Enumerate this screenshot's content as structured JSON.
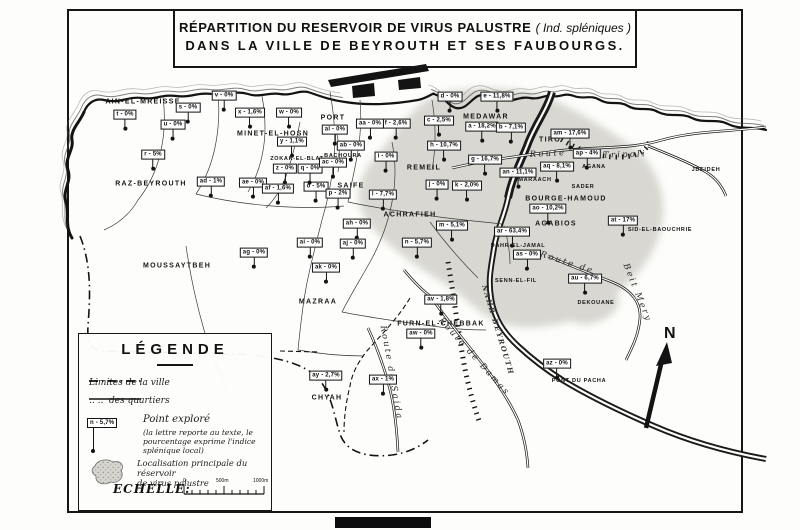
{
  "title": {
    "main": "RÉPARTITION DU RESERVOIR DE VIRUS PALUSTRE",
    "paren": "( Ind. spléniques )",
    "line2": "DANS LA VILLE DE BEYROUTH ET SES FAUBOURGS."
  },
  "compass": {
    "north_label": "N"
  },
  "legend": {
    "title": "LÉGENDE",
    "limits_city": "Limites de la ville",
    "limits_quarters_ditto": "..   ..",
    "limits_quarters": "des quartiers",
    "point_explored": "Point exploré",
    "point_note": "(la lettre reporte au texte, le pourcentage exprime l'indice splénique local)",
    "sample_point_label": "n - 5,7%",
    "reservoir_line1": "Localisation principale du réservoir",
    "reservoir_line2": "de virus palustre",
    "scale_title": "ECHELLE:",
    "scale_ticks": [
      "0",
      "500m",
      "1000m"
    ]
  },
  "colors": {
    "ink": "#131313",
    "paper": "#fdfdfb",
    "reservoir_stipple": "#a09f97"
  },
  "map": {
    "districts": [
      {
        "name": "AIN-EL-MREISSE",
        "x": 143,
        "y": 102,
        "small": false
      },
      {
        "name": "MINET-EL-HOSN",
        "x": 273,
        "y": 134,
        "small": false
      },
      {
        "name": "PORT",
        "x": 333,
        "y": 118,
        "small": false
      },
      {
        "name": "MEDAWAR",
        "x": 486,
        "y": 117,
        "small": false
      },
      {
        "name": "TIRO",
        "x": 550,
        "y": 140,
        "small": false
      },
      {
        "name": "RAZ-BEYROUTH",
        "x": 151,
        "y": 184,
        "small": false
      },
      {
        "name": "ZOKAK-EL-BLAT",
        "x": 297,
        "y": 159,
        "small": true
      },
      {
        "name": "BACHOURA",
        "x": 343,
        "y": 156,
        "small": true
      },
      {
        "name": "SAIFE",
        "x": 351,
        "y": 186,
        "small": false
      },
      {
        "name": "REMEIL",
        "x": 424,
        "y": 168,
        "small": false
      },
      {
        "name": "ACHRAFIEH",
        "x": 410,
        "y": 215,
        "small": false
      },
      {
        "name": "MARAACH",
        "x": 535,
        "y": 180,
        "small": true
      },
      {
        "name": "SADER",
        "x": 583,
        "y": 187,
        "small": true
      },
      {
        "name": "AGANA",
        "x": 594,
        "y": 167,
        "small": true
      },
      {
        "name": "BOURGE-HAMOUD",
        "x": 566,
        "y": 199,
        "small": false
      },
      {
        "name": "AGABIOS",
        "x": 556,
        "y": 224,
        "small": false
      },
      {
        "name": "SID-EL-BAOUCHRIE",
        "x": 660,
        "y": 230,
        "small": true
      },
      {
        "name": "JDEIDEH",
        "x": 706,
        "y": 170,
        "small": true
      },
      {
        "name": "DAHR-EL-JAMAL",
        "x": 518,
        "y": 246,
        "small": true
      },
      {
        "name": "SENN-EL-FIL",
        "x": 516,
        "y": 281,
        "small": true
      },
      {
        "name": "DEKOUANE",
        "x": 596,
        "y": 303,
        "small": true
      },
      {
        "name": "MOUSSAYTBEH",
        "x": 177,
        "y": 266,
        "small": false
      },
      {
        "name": "MAZRAA",
        "x": 318,
        "y": 302,
        "small": false
      },
      {
        "name": "CHYAH",
        "x": 327,
        "y": 398,
        "small": false
      },
      {
        "name": "FURN-EL-CHEBBAK",
        "x": 441,
        "y": 324,
        "small": false
      },
      {
        "name": "PONT DU PACHA",
        "x": 579,
        "y": 381,
        "small": true
      }
    ],
    "points": [
      {
        "id": "a",
        "label": "a - 18,2%",
        "x": 482,
        "y": 130
      },
      {
        "id": "b",
        "label": "b - 7,1%",
        "x": 511,
        "y": 131
      },
      {
        "id": "c",
        "label": "c - 2,5%",
        "x": 439,
        "y": 124
      },
      {
        "id": "d",
        "label": "d - 0%",
        "x": 450,
        "y": 100
      },
      {
        "id": "e",
        "label": "e - 11,8%",
        "x": 497,
        "y": 100
      },
      {
        "id": "f",
        "label": "f - 2,6%",
        "x": 396,
        "y": 127
      },
      {
        "id": "g",
        "label": "g - 16,7%",
        "x": 485,
        "y": 163
      },
      {
        "id": "h",
        "label": "h - 10,7%",
        "x": 444,
        "y": 149
      },
      {
        "id": "i",
        "label": "i - 0%",
        "x": 386,
        "y": 160
      },
      {
        "id": "j",
        "label": "j - 0%",
        "x": 437,
        "y": 188
      },
      {
        "id": "k",
        "label": "k - 2,0%",
        "x": 467,
        "y": 189
      },
      {
        "id": "l",
        "label": "l - 7,7%",
        "x": 383,
        "y": 198
      },
      {
        "id": "m",
        "label": "m - 5,1%",
        "x": 452,
        "y": 229
      },
      {
        "id": "n",
        "label": "n - 5,7%",
        "x": 417,
        "y": 246
      },
      {
        "id": "o",
        "label": "o - 5%",
        "x": 316,
        "y": 190
      },
      {
        "id": "p",
        "label": "p - 2%",
        "x": 338,
        "y": 197
      },
      {
        "id": "q",
        "label": "q - 0%",
        "x": 310,
        "y": 172
      },
      {
        "id": "r",
        "label": "r - 5%",
        "x": 153,
        "y": 158
      },
      {
        "id": "s",
        "label": "s - 0%",
        "x": 188,
        "y": 111
      },
      {
        "id": "t",
        "label": "t - 0%",
        "x": 125,
        "y": 118
      },
      {
        "id": "u",
        "label": "u - 0%",
        "x": 173,
        "y": 128
      },
      {
        "id": "v",
        "label": "v - 0%",
        "x": 224,
        "y": 99
      },
      {
        "id": "w",
        "label": "w - 0%",
        "x": 289,
        "y": 116
      },
      {
        "id": "x",
        "label": "x - 1,6%",
        "x": 250,
        "y": 116
      },
      {
        "id": "y",
        "label": "y - 1,1%",
        "x": 292,
        "y": 145
      },
      {
        "id": "z",
        "label": "z - 0%",
        "x": 285,
        "y": 172
      },
      {
        "id": "aa",
        "label": "aa - 0%",
        "x": 370,
        "y": 127
      },
      {
        "id": "ab",
        "label": "ab - 0%",
        "x": 351,
        "y": 149
      },
      {
        "id": "ac",
        "label": "ac - 0%",
        "x": 333,
        "y": 166
      },
      {
        "id": "ad",
        "label": "ad - 1%",
        "x": 211,
        "y": 185
      },
      {
        "id": "ae",
        "label": "ae - 0%",
        "x": 253,
        "y": 186
      },
      {
        "id": "af",
        "label": "af - 1,6%",
        "x": 278,
        "y": 192
      },
      {
        "id": "ag",
        "label": "ag - 0%",
        "x": 254,
        "y": 256
      },
      {
        "id": "ah",
        "label": "ah - 0%",
        "x": 357,
        "y": 227
      },
      {
        "id": "ai",
        "label": "ai - 0%",
        "x": 310,
        "y": 246
      },
      {
        "id": "aj",
        "label": "aj - 0%",
        "x": 353,
        "y": 247
      },
      {
        "id": "ak",
        "label": "ak - 0%",
        "x": 326,
        "y": 271
      },
      {
        "id": "al",
        "label": "al - 0%",
        "x": 335,
        "y": 133
      },
      {
        "id": "am",
        "label": "am - 17,6%",
        "x": 570,
        "y": 137
      },
      {
        "id": "an",
        "label": "an - 11,1%",
        "x": 518,
        "y": 176
      },
      {
        "id": "ao",
        "label": "ao - 10,2%",
        "x": 548,
        "y": 212
      },
      {
        "id": "ap",
        "label": "ap - 4%",
        "x": 587,
        "y": 157
      },
      {
        "id": "aq",
        "label": "aq - 8,1%",
        "x": 557,
        "y": 170
      },
      {
        "id": "ar",
        "label": "ar - 63,4%",
        "x": 512,
        "y": 235
      },
      {
        "id": "as",
        "label": "as - 0%",
        "x": 527,
        "y": 258
      },
      {
        "id": "at",
        "label": "at - 17%",
        "x": 623,
        "y": 224
      },
      {
        "id": "au",
        "label": "au - 6,7%",
        "x": 585,
        "y": 282
      },
      {
        "id": "av",
        "label": "av - 1,8%",
        "x": 441,
        "y": 303
      },
      {
        "id": "aw",
        "label": "aw - 0%",
        "x": 421,
        "y": 337
      },
      {
        "id": "ax",
        "label": "ax - 1%",
        "x": 383,
        "y": 383
      },
      {
        "id": "ay",
        "label": "ay - 2,7%",
        "x": 326,
        "y": 379
      },
      {
        "id": "az",
        "label": "az - 0%",
        "x": 557,
        "y": 367
      }
    ],
    "road_labels": [
      {
        "text": "Route",
        "x": 548,
        "y": 154,
        "rot": -3,
        "cls": ""
      },
      {
        "text": "de",
        "x": 585,
        "y": 155,
        "rot": -2,
        "cls": ""
      },
      {
        "text": "Tripoli",
        "x": 625,
        "y": 155,
        "rot": -2,
        "cls": ""
      },
      {
        "text": "Route de",
        "x": 567,
        "y": 263,
        "rot": 18,
        "cls": ""
      },
      {
        "text": "Beit Mery",
        "x": 637,
        "y": 293,
        "rot": 68,
        "cls": ""
      },
      {
        "text": "Route de Saida",
        "x": 391,
        "y": 373,
        "rot": 80,
        "cls": ""
      },
      {
        "text": "Route de Damas",
        "x": 474,
        "y": 357,
        "rot": 48,
        "cls": ""
      },
      {
        "text": "NAHR-BEYROUTH",
        "x": 498,
        "y": 330,
        "rot": 73,
        "cls": "riv"
      }
    ]
  }
}
